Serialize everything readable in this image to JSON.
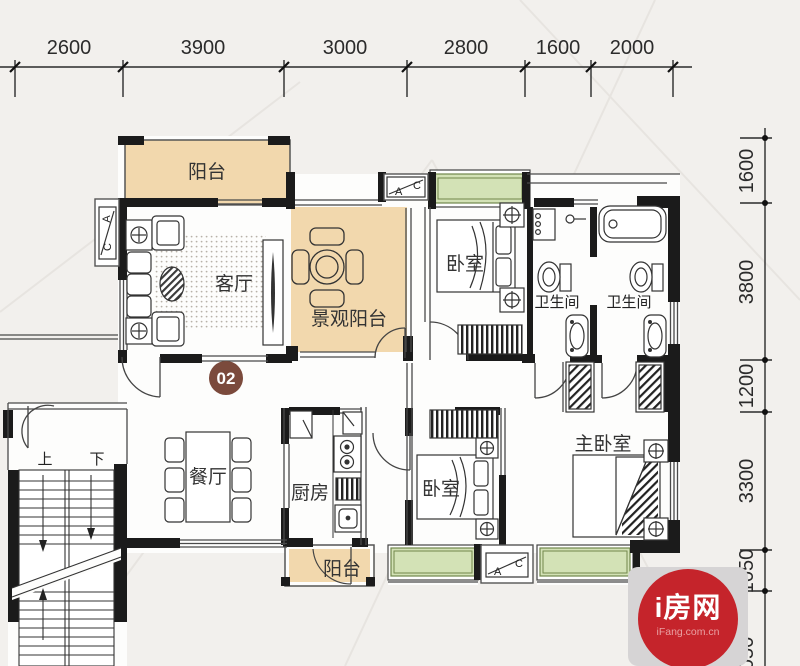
{
  "title": "apartment-floor-plan",
  "rulers": {
    "top": {
      "labels": [
        "2600",
        "3900",
        "3000",
        "2800",
        "1600",
        "2000"
      ]
    },
    "right": {
      "labels": [
        "1600",
        "3800",
        "1200",
        "3300",
        "1050",
        "1050"
      ]
    }
  },
  "rooms": {
    "balcony_top": "阳台",
    "living": "客厅",
    "view_balcony": "景观阳台",
    "bedroom_top": "卧室",
    "bath_left": "卫生间",
    "bath_right": "卫生间",
    "dining": "餐厅",
    "kitchen": "厨房",
    "bedroom_bottom": "卧室",
    "master": "主卧室",
    "balcony_bottom": "阳台"
  },
  "stairs": {
    "up": "上",
    "down": "下"
  },
  "badge": {
    "label": "02"
  },
  "ac": {
    "a": "A",
    "c": "C"
  },
  "logo": {
    "title": "i房网",
    "domain": "iFang.com.cn"
  },
  "colors": {
    "background": "#f2f0ed",
    "wall": "#1b1b1b",
    "balcony_fill": "#f2d8ad",
    "bay_window_fill": "#d3e2b6",
    "badge_bg": "#7b4a3c",
    "logo_red": "#c5242b",
    "logo_gray": "#d6d4d5"
  }
}
